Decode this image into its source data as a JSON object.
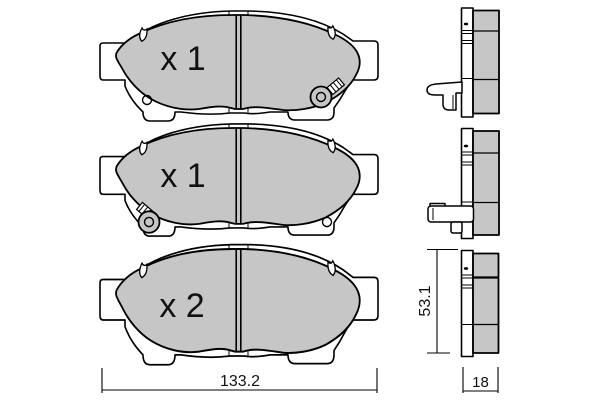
{
  "drawing": {
    "front_views": [
      {
        "label": "x 1"
      },
      {
        "label": "x 1"
      },
      {
        "label": "x 2"
      }
    ],
    "dimensions": {
      "overall_width": "133.2",
      "overall_height": "53.1",
      "thickness": "18"
    },
    "colors": {
      "friction_material": "#c6c6c6",
      "outline": "#000000",
      "background": "#ffffff"
    }
  }
}
